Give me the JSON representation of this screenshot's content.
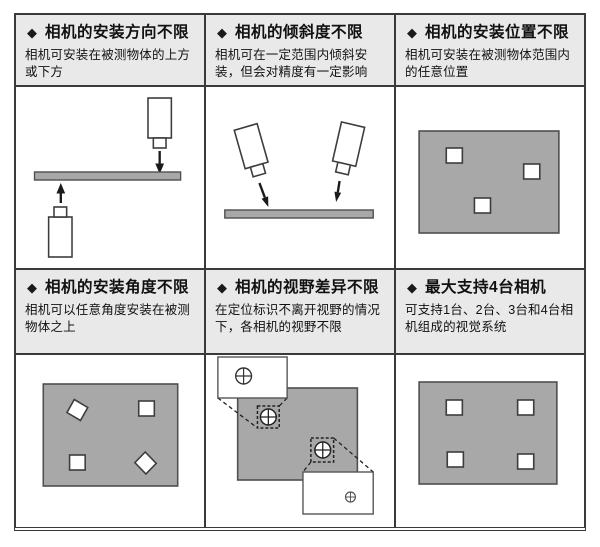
{
  "bullet": "◆",
  "colors": {
    "header_bg": "#e9e9e9",
    "grid_border": "#3a3a3a",
    "shape_fill": "#a8a8a8",
    "shape_stroke": "#4f4f4f",
    "text": "#111111"
  },
  "panels": [
    {
      "title": "相机的安装方向不限",
      "description": "相机可安装在被测物体的上方或下方",
      "figure": "camera-above-and-below-object"
    },
    {
      "title": "相机的倾斜度不限",
      "description": "相机可在一定范围内倾斜安装，但会对精度有一定影响",
      "figure": "two-tilted-cameras-over-object"
    },
    {
      "title": "相机的安装位置不限",
      "description": "相机可安装在被测物体范围内的任意位置",
      "figure": "object-with-three-markers"
    },
    {
      "title": "相机的安装角度不限",
      "description": "相机可以任意角度安装在被测物体之上",
      "figure": "object-with-four-rotated-markers"
    },
    {
      "title": "相机的视野差异不限",
      "description": "在定位标识不离开视野的情况下，各相机的视野不限",
      "figure": "two-camera-fields-of-view-with-markers"
    },
    {
      "title": "最大支持4台相机",
      "description": "可支持1台、2台、3台和4台相机组成的视觉系统",
      "figure": "object-with-four-markers"
    }
  ]
}
